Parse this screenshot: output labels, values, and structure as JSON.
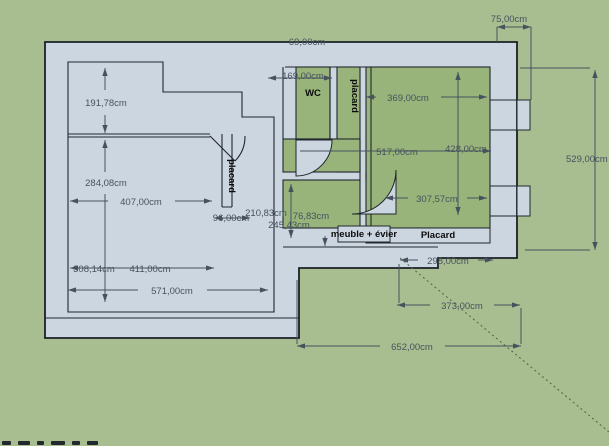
{
  "viewport": {
    "width": 609,
    "height": 446,
    "background": "#a8bd90"
  },
  "colors": {
    "background_green": "#a8bd90",
    "wall_fill": "#ccd6e1",
    "room_green": "#98b47a",
    "outline_dark": "#20262d",
    "dimension_gray": "#47525e"
  },
  "room_labels": {
    "wc": "WC",
    "closet_left_vertical": "placard",
    "closet_strip_vertical": "placard",
    "cabinet_box": "meuble + évier",
    "closet_bottom": "Placard"
  },
  "dimensions": {
    "top_offset": "75,00cm",
    "top_wall": "69,00cm",
    "wc_width": "169,00cm",
    "bedroom_width": "369,00cm",
    "mid_width": "517,00cm",
    "bedroom_height": "428,00cm",
    "bedroom_inner": "307,57cm",
    "left_top_height": "191,78cm",
    "left_mid_height": "284,08cm",
    "left_room_width": "407,00cm",
    "closet_width": "96,00cm",
    "hall_width": "210,83cm",
    "door_width": "76,83cm",
    "bath_width": "245,43cm",
    "left_low_height": "308,14cm",
    "left_inner_width": "411,00cm",
    "left_total_width": "571,00cm",
    "bottom_band": "298,00cm",
    "bottom_mid": "373,00cm",
    "bottom_total": "652,00cm",
    "right_total_height": "529,00cm"
  }
}
